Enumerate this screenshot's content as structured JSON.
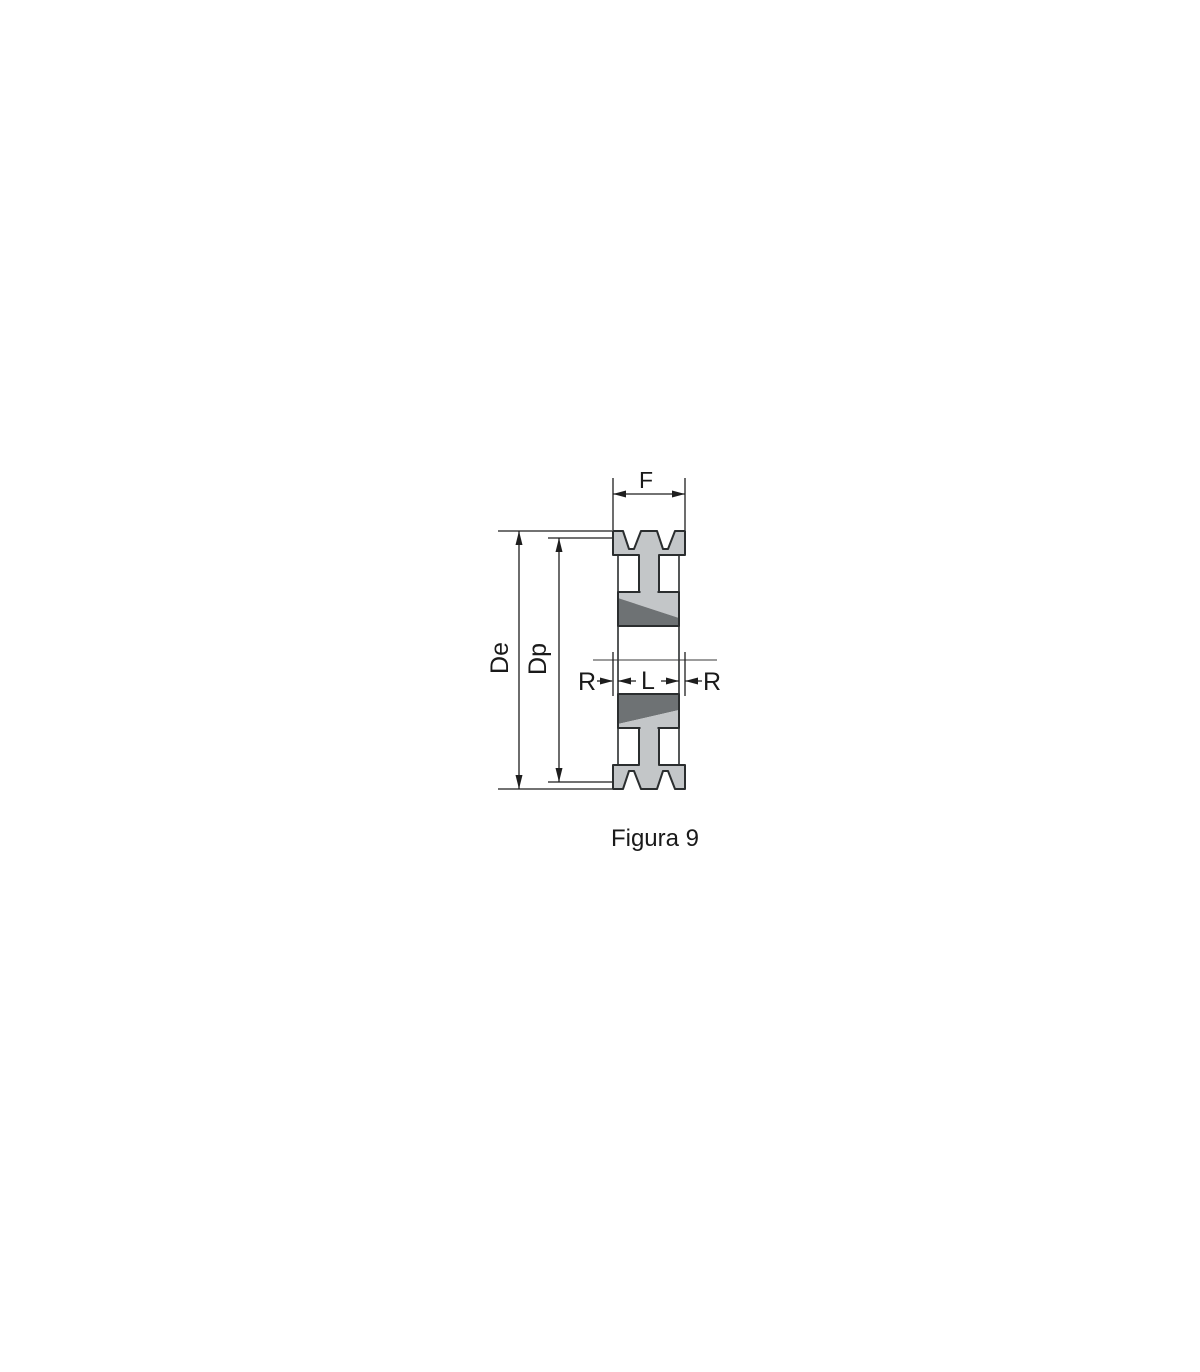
{
  "figure": {
    "caption": "Figura 9",
    "labels": {
      "face_width": "F",
      "outside_diameter": "De",
      "pitch_diameter": "Dp",
      "offset_left": "R",
      "bush_length": "L",
      "offset_right": "R"
    },
    "colors": {
      "background": "#ffffff",
      "body_fill": "#c3c6c8",
      "bush_dark_fill": "#6e7274",
      "line": "#2b2e2f",
      "text": "#1a1a1a"
    }
  }
}
